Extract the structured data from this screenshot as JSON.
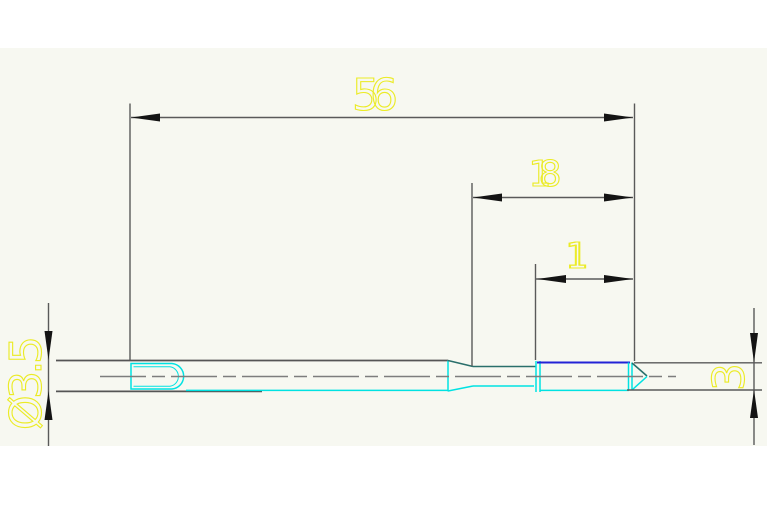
{
  "drawing": {
    "title": "CAD technical drawing - stepped pin tool, side view",
    "labels": {
      "dim_56": "56",
      "dim_18": "18",
      "dim_11": "11",
      "dim_dia_3_5": "Ø3.5",
      "dim_3": "3"
    },
    "colors": {
      "page_bg": "#ffffff",
      "viewport_bg": "#f7f8f1",
      "dim_text": "#ebeb25",
      "dim_line": "#5a5a5a",
      "arrow": "#141414",
      "part_edge": "#555555",
      "part_teal": "#2a6f6b",
      "part_cyan": "#00e2e2",
      "part_blue": "#2222d6",
      "centerline": "#7d7d7d"
    }
  }
}
